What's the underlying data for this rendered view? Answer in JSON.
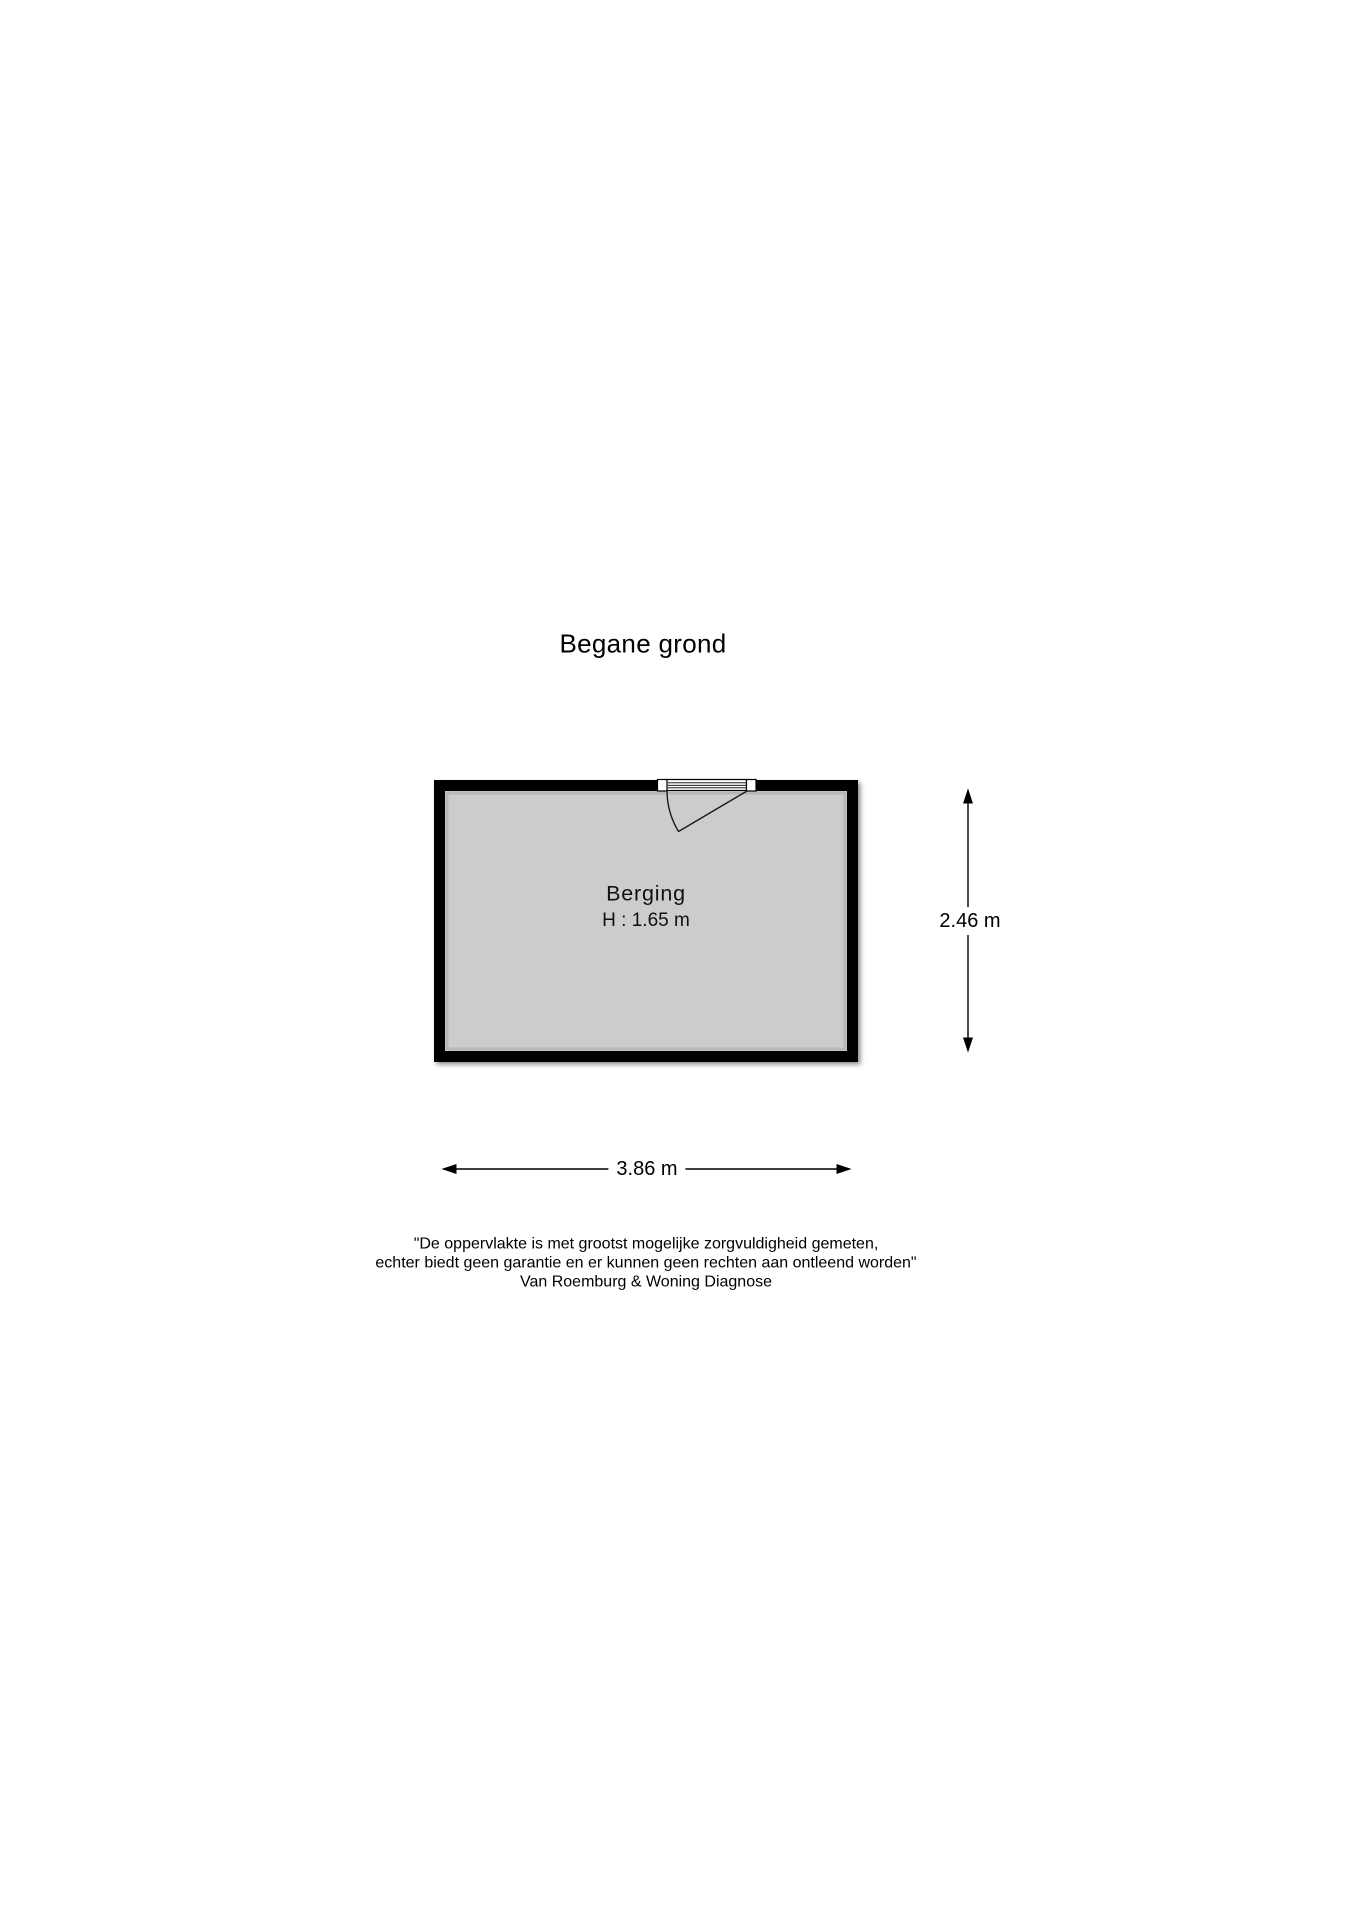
{
  "page": {
    "title": "Begane grond",
    "background_color": "#ffffff"
  },
  "floorplan": {
    "room": {
      "label": "Berging",
      "ceiling_height": "H : 1.65 m"
    },
    "dimensions": {
      "width": "3.86 m",
      "depth": "2.46 m"
    },
    "colors": {
      "wall": "#000000",
      "floor": "#cccccc",
      "door": "#ffffff"
    }
  },
  "disclaimer": {
    "line1": "\"De oppervlakte is met grootst mogelijke zorgvuldigheid gemeten,",
    "line2": "echter biedt geen garantie en er kunnen geen rechten aan ontleend worden\"",
    "line3": "Van Roemburg & Woning Diagnose"
  }
}
